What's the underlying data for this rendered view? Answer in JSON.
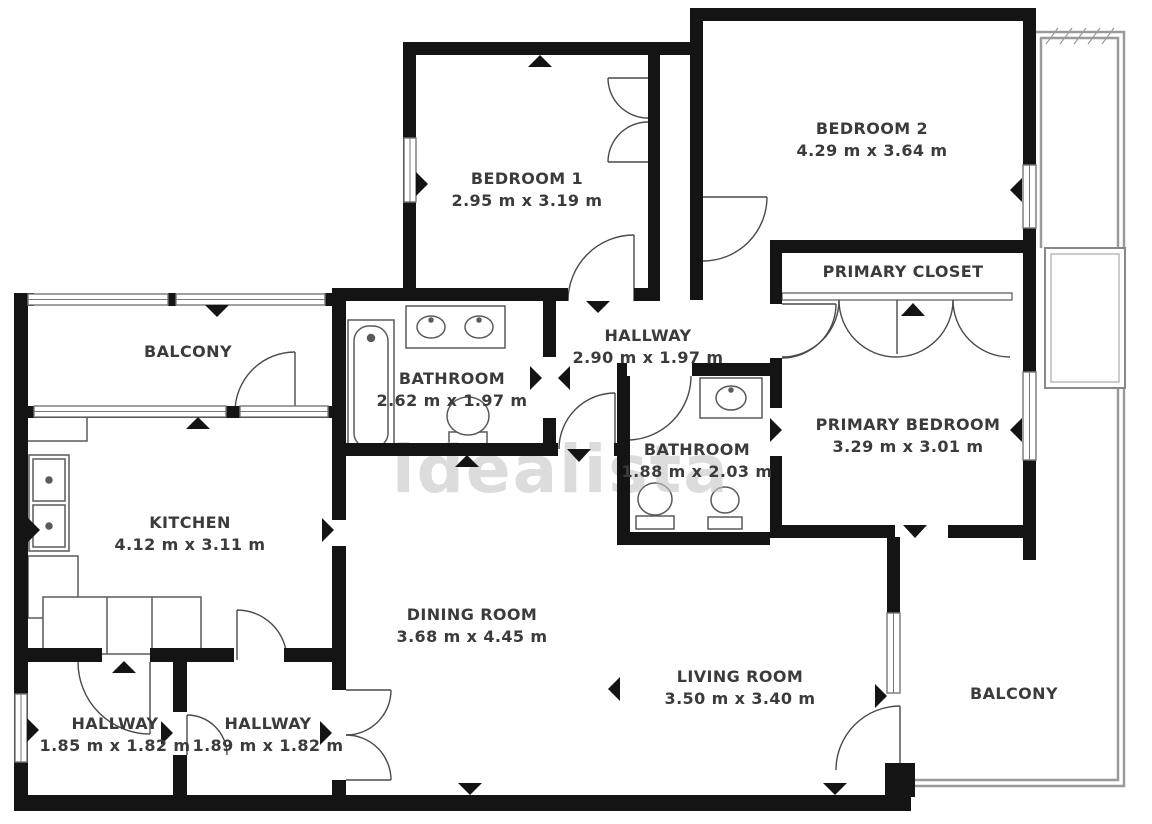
{
  "watermark": "idealista",
  "rooms": [
    {
      "name": "BEDROOM 1",
      "dims": "2.95 m x 3.19 m"
    },
    {
      "name": "BEDROOM 2",
      "dims": "4.29 m x 3.64 m"
    },
    {
      "name": "PRIMARY CLOSET",
      "dims": ""
    },
    {
      "name": "HALLWAY",
      "dims": "2.90 m x 1.97 m"
    },
    {
      "name": "BATHROOM",
      "dims": "2.62 m x 1.97 m"
    },
    {
      "name": "BATHROOM",
      "dims": "1.88 m x 2.03 m"
    },
    {
      "name": "PRIMARY BEDROOM",
      "dims": "3.29 m x 3.01 m"
    },
    {
      "name": "BALCONY",
      "dims": ""
    },
    {
      "name": "KITCHEN",
      "dims": "4.12 m x 3.11 m"
    },
    {
      "name": "DINING ROOM",
      "dims": "3.68 m x 4.45 m"
    },
    {
      "name": "LIVING ROOM",
      "dims": "3.50 m x 3.40 m"
    },
    {
      "name": "HALLWAY",
      "dims": "1.85 m x 1.82 m"
    },
    {
      "name": "HALLWAY",
      "dims": "1.89 m x 1.82 m"
    },
    {
      "name": "BALCONY",
      "dims": ""
    }
  ],
  "colors": {
    "wall": "#141414",
    "fixture": "#5a5a5a",
    "railing": "#9a9a9a",
    "watermark": "#c6c6c6",
    "label": "#3b3b3b"
  }
}
